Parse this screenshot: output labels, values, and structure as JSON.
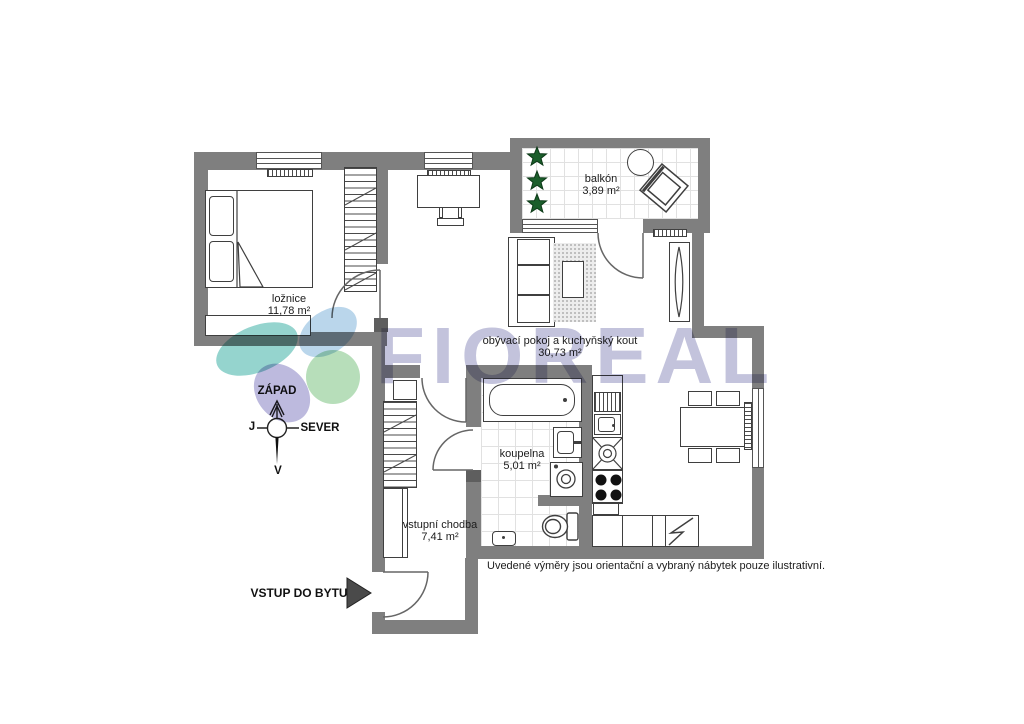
{
  "watermark": {
    "brand": "FIOREAL"
  },
  "rooms": {
    "bedroom": {
      "name": "ložnice",
      "area": "11,78 m²"
    },
    "balcony": {
      "name": "balkón",
      "area": "3,89 m²"
    },
    "living_kitchen": {
      "name": "obývací pokoj a kuchyňský kout",
      "area": "30,73 m²"
    },
    "bathroom": {
      "name": "koupelna",
      "area": "5,01 m²"
    },
    "hallway": {
      "name": "vstupní chodba",
      "area": "7,41 m²"
    }
  },
  "compass": {
    "top": "ZÁPAD",
    "right": "SEVER",
    "left": "J",
    "bottom": "V"
  },
  "entrance": {
    "label": "VSTUP DO BYTU"
  },
  "note": "Uvedené výměry jsou orientační a vybraný nábytek pouze ilustrativní.",
  "colors": {
    "wall": "#7f7f7f",
    "wall_dark": "#5e5e5e",
    "outline": "#3f3f3f",
    "plant_green": "#1b5e2b",
    "watermark_purple": "#c3c3dc",
    "tile_gray": "#e1e1e1"
  }
}
